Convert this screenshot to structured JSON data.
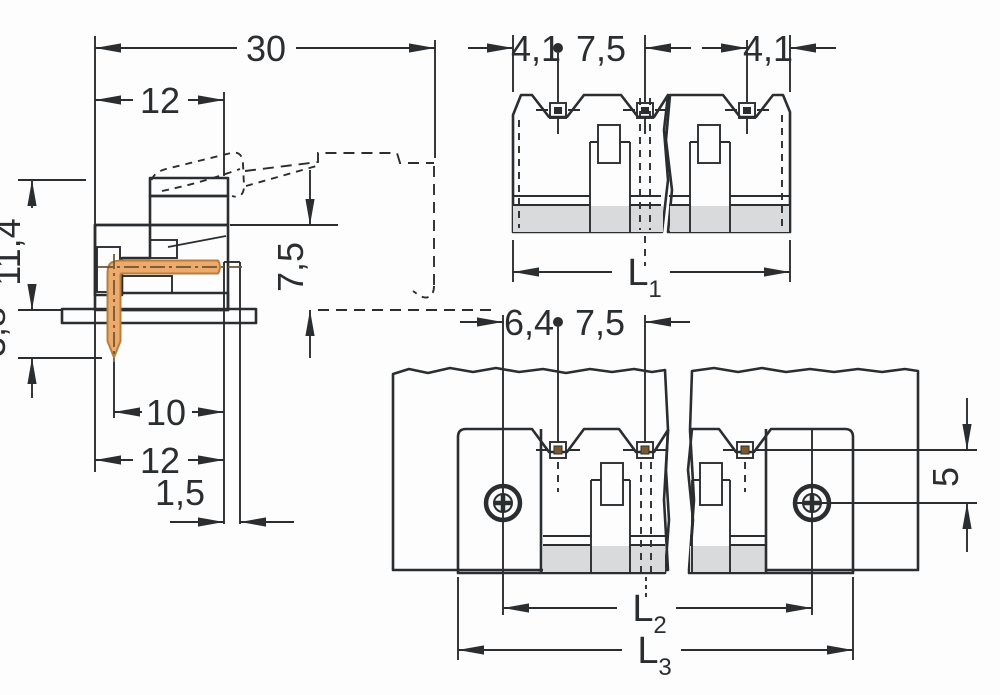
{
  "drawing_type": "connector-technical-dimension-drawing",
  "colors": {
    "line": "#2b2e30",
    "body_fill": "#e4e6e7",
    "body_shade": "#d8dadb",
    "hatch_background": "#eceeee",
    "pcb_green": "#85aa7d",
    "pcb_hatch": "#3c5c38",
    "copper_pin": "#ecaa6c",
    "copper_outline": "#b97e3e",
    "background": "#fdfdfd"
  },
  "side_view": {
    "dim_total_depth": "30",
    "dim_body_depth_top": "12",
    "dim_height": "11,4",
    "dim_pin_protrusion": "3,8",
    "dim_mating_depth": "7,5",
    "dim_pin_to_front": "10",
    "dim_body_depth_bottom": "12",
    "dim_edge_offset": "1,5"
  },
  "front_view": {
    "dim_edge_to_pin_left": "4,1",
    "dim_pin_pitch": "7,5",
    "dim_edge_to_pin_right": "4,1",
    "dim_total_length_base": "L",
    "dim_total_length_sub": "1"
  },
  "board_view": {
    "dim_screw_to_pin": "6,4",
    "dim_pin_pitch": "7,5",
    "dim_pin_to_screw": "5",
    "dim_pin_span_base": "L",
    "dim_pin_span_sub": "2",
    "dim_total_length_base": "L",
    "dim_total_length_sub": "3"
  }
}
